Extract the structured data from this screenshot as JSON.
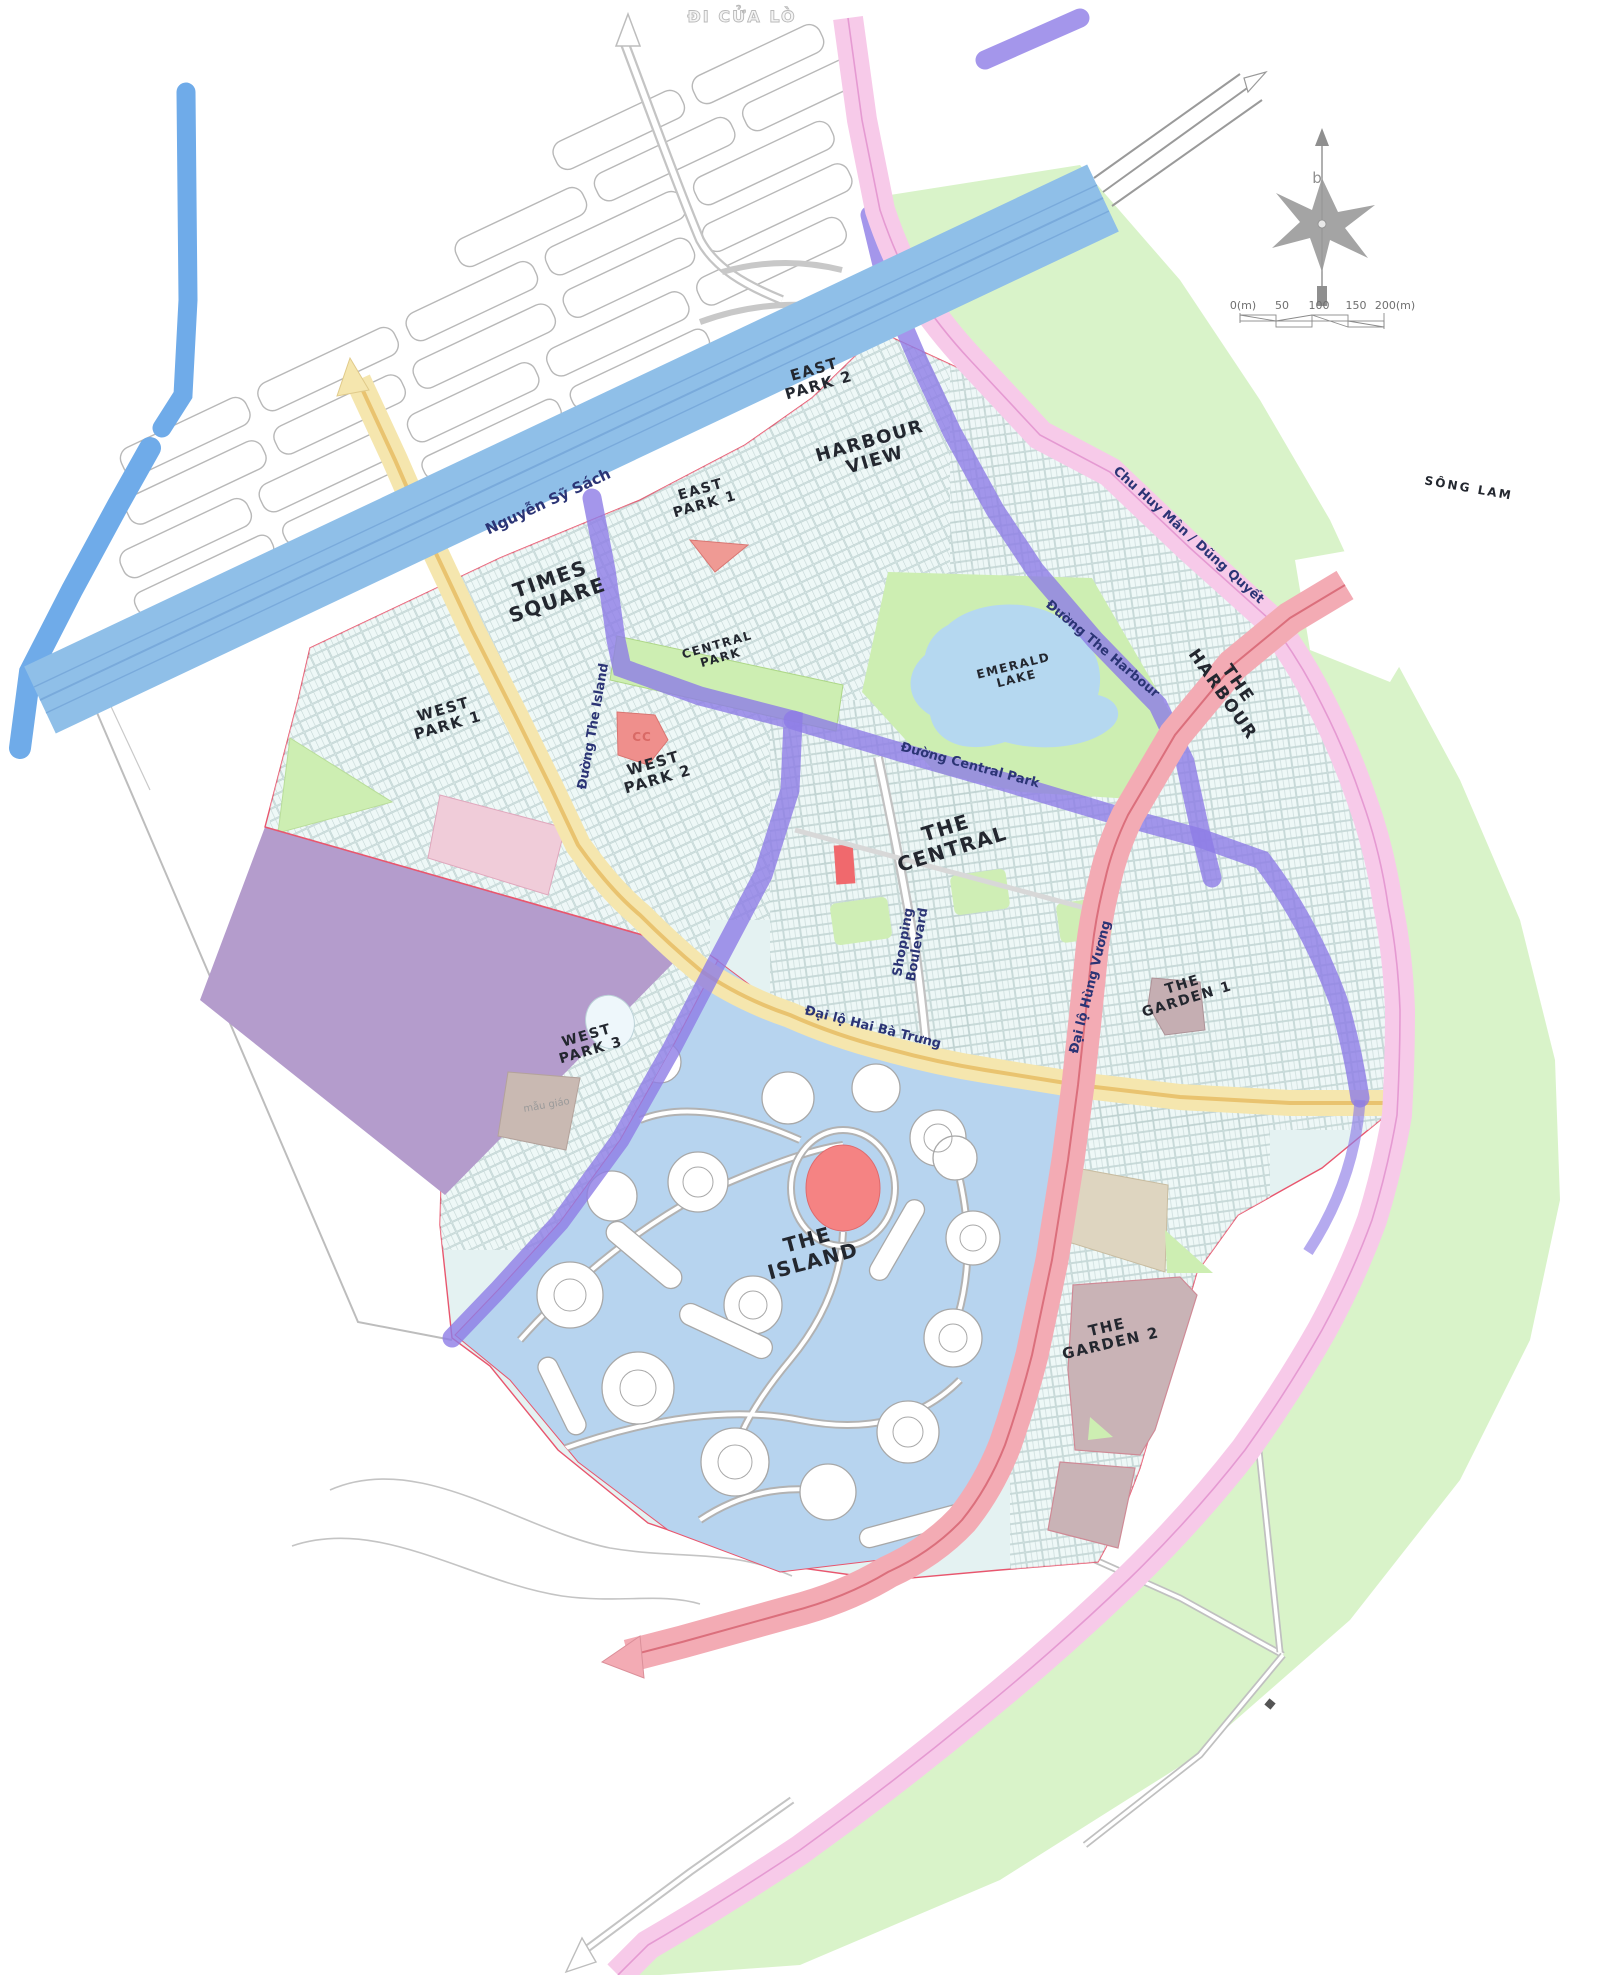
{
  "map_title": "Eco-urban master plan",
  "compass": {
    "north_letter": "b"
  },
  "scale_bar": {
    "ticks": [
      {
        "text": "0(m)",
        "x": 1243
      },
      {
        "text": "50",
        "x": 1282
      },
      {
        "text": "100",
        "x": 1319
      },
      {
        "text": "150",
        "x": 1356
      },
      {
        "text": "200(m)",
        "x": 1395
      }
    ],
    "y": 309
  },
  "colors": {
    "highway_blue": "#8fbfe8",
    "canal_blue": "#6fabe9",
    "ring_road_pink": "#f7cae9",
    "avenue_red": "#f3abb4",
    "avenue_yellow": "#f5e6ae",
    "internal_road_purple": "#8d7ce6",
    "zone_fill": "#e4f2f2",
    "island_fill": "#b7d4ef",
    "park_green": "#cdeeb2",
    "riverbank_green": "#d9f3c9",
    "lake_blue": "#b5d8f0",
    "reserve_purple": "#b49ccc",
    "garden_mauve": "#c9b3b6",
    "landmark_red": "#f28383",
    "boundary_red": "#e8566e"
  },
  "labels": [
    {
      "id": "di-cua-lo",
      "text": "ĐI CỬA LÒ",
      "x": 742,
      "y": 22,
      "rot": 0,
      "size": 16,
      "cls": "outline"
    },
    {
      "id": "nguyen-sy-sach",
      "text": "Nguyễn Sỹ Sách",
      "x": 550,
      "y": 506,
      "rot": -25,
      "size": 15,
      "cls": "road"
    },
    {
      "id": "east-park-2",
      "lines": [
        "EAST",
        "PARK 2"
      ],
      "x": 818,
      "y": 382,
      "rot": -16,
      "size": 15,
      "cls": "zone"
    },
    {
      "id": "harbour-view",
      "lines": [
        "HARBOUR",
        "VIEW"
      ],
      "x": 874,
      "y": 456,
      "rot": -16,
      "size": 18,
      "cls": "zone"
    },
    {
      "id": "east-park-1",
      "lines": [
        "EAST",
        "PARK 1"
      ],
      "x": 704,
      "y": 501,
      "rot": -16,
      "size": 14,
      "cls": "zone"
    },
    {
      "id": "times-square",
      "lines": [
        "TIMES",
        "SQUARE"
      ],
      "x": 556,
      "y": 596,
      "rot": -19,
      "size": 20,
      "cls": "zone"
    },
    {
      "id": "west-park-1",
      "lines": [
        "WEST",
        "PARK 1"
      ],
      "x": 447,
      "y": 722,
      "rot": -16,
      "size": 15,
      "cls": "zone"
    },
    {
      "id": "west-park-2",
      "lines": [
        "WEST",
        "PARK 2"
      ],
      "x": 657,
      "y": 776,
      "rot": -16,
      "size": 15,
      "cls": "zone"
    },
    {
      "id": "central-park",
      "lines": [
        "CENTRAL",
        "PARK"
      ],
      "x": 720,
      "y": 655,
      "rot": -16,
      "size": 12,
      "cls": "zone"
    },
    {
      "id": "emerald-lake",
      "lines": [
        "EMERALD",
        "LAKE"
      ],
      "x": 1016,
      "y": 676,
      "rot": -14,
      "size": 12,
      "cls": "zone"
    },
    {
      "id": "duong-the-harbour",
      "text": "Đường The Harbour",
      "x": 1100,
      "y": 652,
      "rot": 40,
      "size": 13,
      "cls": "road"
    },
    {
      "id": "chu-huy-man",
      "text": "Chu Huy Mân / Dũng Quyết",
      "x": 1186,
      "y": 538,
      "rot": 42,
      "size": 13,
      "cls": "road"
    },
    {
      "id": "the-harbour",
      "lines": [
        "THE",
        "HARBOUR"
      ],
      "x": 1226,
      "y": 692,
      "rot": 55,
      "size": 17,
      "cls": "zone"
    },
    {
      "id": "song-lam",
      "text": "SÔNG LAM",
      "x": 1468,
      "y": 492,
      "rot": 10,
      "size": 12,
      "cls": "zone-sm"
    },
    {
      "id": "duong-central-park",
      "text": "Đường Central Park",
      "x": 969,
      "y": 769,
      "rot": 15,
      "size": 13,
      "cls": "road"
    },
    {
      "id": "duong-the-island",
      "text": "Đường The Island",
      "x": 597,
      "y": 727,
      "rot": -80,
      "size": 13,
      "cls": "road"
    },
    {
      "id": "the-central",
      "lines": [
        "THE",
        "CENTRAL"
      ],
      "x": 951,
      "y": 845,
      "rot": -17,
      "size": 20,
      "cls": "zone"
    },
    {
      "id": "shopping-boulevard",
      "lines": [
        "Shopping",
        "Boulevard"
      ],
      "x": 914,
      "y": 944,
      "rot": -80,
      "size": 13,
      "cls": "road"
    },
    {
      "id": "dai-lo-hung-vuong",
      "text": "Đại lộ Hùng Vương",
      "x": 1094,
      "y": 988,
      "rot": -76,
      "size": 13,
      "cls": "road"
    },
    {
      "id": "dai-lo-hai-ba-trung",
      "text": "Đại lộ Hai Bà Trưng",
      "x": 872,
      "y": 1031,
      "rot": 14,
      "size": 13,
      "cls": "road"
    },
    {
      "id": "the-garden-1",
      "lines": [
        "THE",
        "GARDEN 1"
      ],
      "x": 1186,
      "y": 996,
      "rot": -17,
      "size": 14,
      "cls": "zone"
    },
    {
      "id": "west-park-3",
      "lines": [
        "WEST",
        "PARK 3"
      ],
      "x": 590,
      "y": 1047,
      "rot": -16,
      "size": 14,
      "cls": "zone"
    },
    {
      "id": "mau-giao",
      "text": "mẫu giáo",
      "x": 547,
      "y": 1108,
      "rot": -10,
      "size": 10,
      "cls": "minor"
    },
    {
      "id": "the-island",
      "lines": [
        "THE",
        "ISLAND"
      ],
      "x": 812,
      "y": 1257,
      "rot": -15,
      "size": 20,
      "cls": "zone"
    },
    {
      "id": "the-garden-2",
      "lines": [
        "THE",
        "GARDEN 2"
      ],
      "x": 1110,
      "y": 1340,
      "rot": -13,
      "size": 15,
      "cls": "zone"
    },
    {
      "id": "cc-block",
      "text": "CC",
      "x": 642,
      "y": 741,
      "rot": 0,
      "size": 12,
      "cls": "cc"
    },
    {
      "id": "compass-letter",
      "text": "b",
      "x": 1317,
      "y": 183,
      "rot": 0,
      "size": 15,
      "cls": "compass"
    }
  ]
}
